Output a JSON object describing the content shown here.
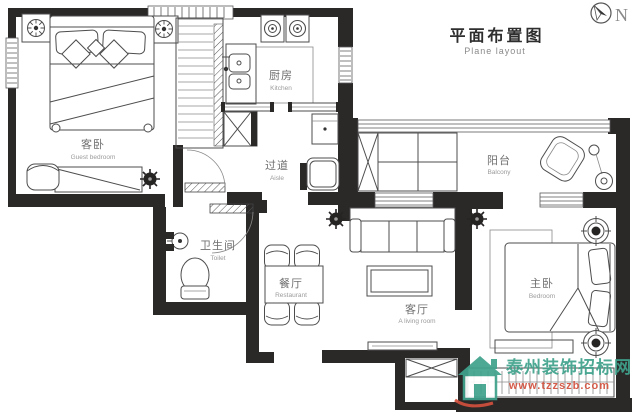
{
  "title": {
    "zh": "平面布置图",
    "en": "Plane layout"
  },
  "compass": {
    "label": "N"
  },
  "rooms": {
    "guest_bedroom": {
      "zh": "客卧",
      "en": "Guest bedroom"
    },
    "kitchen": {
      "zh": "厨房",
      "en": "Kitchen"
    },
    "aisle": {
      "zh": "过道",
      "en": "Aisle"
    },
    "balcony": {
      "zh": "阳台",
      "en": "Balcony"
    },
    "toilet": {
      "zh": "卫生间",
      "en": "Toilet"
    },
    "dining": {
      "zh": "餐厅",
      "en": "Restaurant"
    },
    "living": {
      "zh": "客厅",
      "en": "A living room"
    },
    "master_bedroom": {
      "zh": "主卧",
      "en": "Bedroom"
    }
  },
  "watermark": {
    "site": "泰州装饰招标网",
    "url": "www.tzzszb.com"
  },
  "icons": {
    "compass": "north-compass-icon",
    "plant": "plant-icon",
    "lamp": "bedside-lamp-icon"
  },
  "colors": {
    "wall": "#2b2828",
    "furniture_line": "#4d4d4d",
    "label_text": "#6f6f6f",
    "watermark_green": "#3fa28c",
    "watermark_red": "#d2503c"
  }
}
